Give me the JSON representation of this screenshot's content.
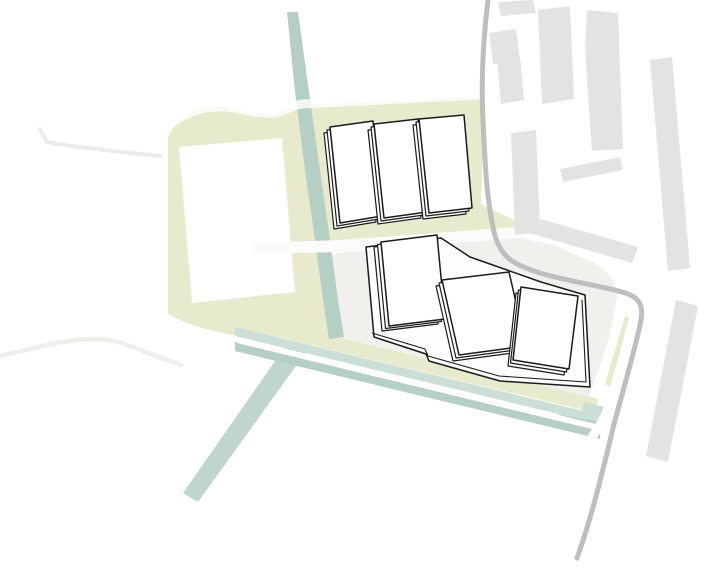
{
  "diagram": {
    "kind": "architectural-site-plan",
    "colors": {
      "background": "#ffffff",
      "site_area": "#f0f0ec",
      "field_yellow": "#e7eacc",
      "teal": "#b5cfc4",
      "teal_light": "#ccdfd6",
      "teal_branch": "#c0d6cc",
      "context_building": "#e3e3e1",
      "ring_road": "#bebebd",
      "minor_road": "#ececea",
      "minor_road_2": "#efefec",
      "road_overlay": "#fbfbf9",
      "white": "#ffffff",
      "building_fill": "#ffffff",
      "plate_fill": "#fdfdfb",
      "building_outline": "#1b1b1b"
    },
    "legend": {
      "site_area": "development site ground",
      "field_yellow": "green/field zones",
      "teal_paths": "landscape canal and avenue bands",
      "white_buildings": "proposed building volumes",
      "gray_buildings": "existing context buildings",
      "ring_road": "curved perimeter road"
    }
  }
}
